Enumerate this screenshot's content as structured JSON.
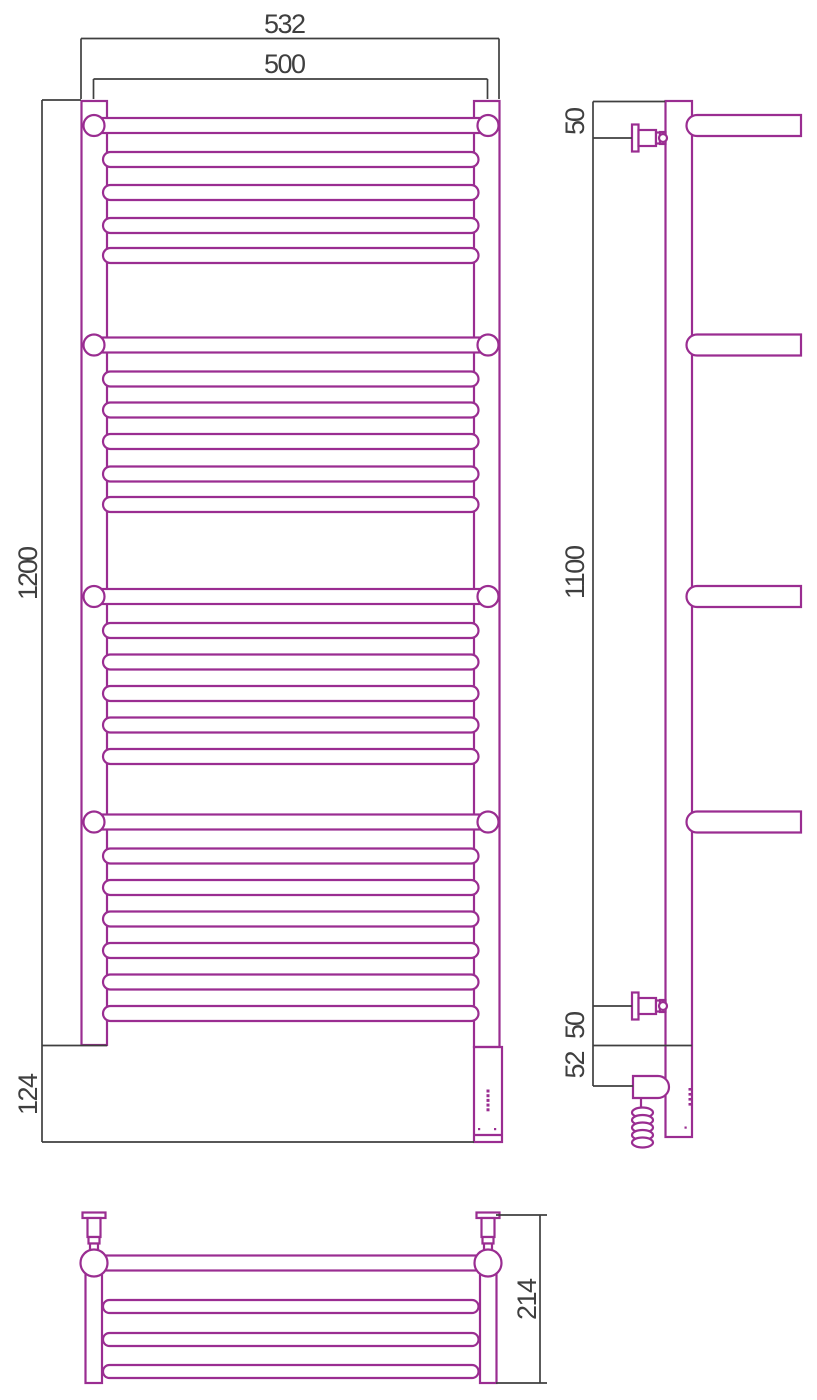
{
  "colors": {
    "product_line": "#9a2d91",
    "dimension_line": "#3f3f3f",
    "background": "#ffffff"
  },
  "dimensions_mm": {
    "front_view": {
      "overall_width": "532",
      "axis_width": "500",
      "height": "1200",
      "element_zone_height": "124"
    },
    "side_view": {
      "top_bracket_offset": "50",
      "bracket_span": "1100",
      "bottom_bracket_offset": "50",
      "element_axis_offset": "52"
    },
    "bottom_view": {
      "overall_depth": "214"
    }
  }
}
